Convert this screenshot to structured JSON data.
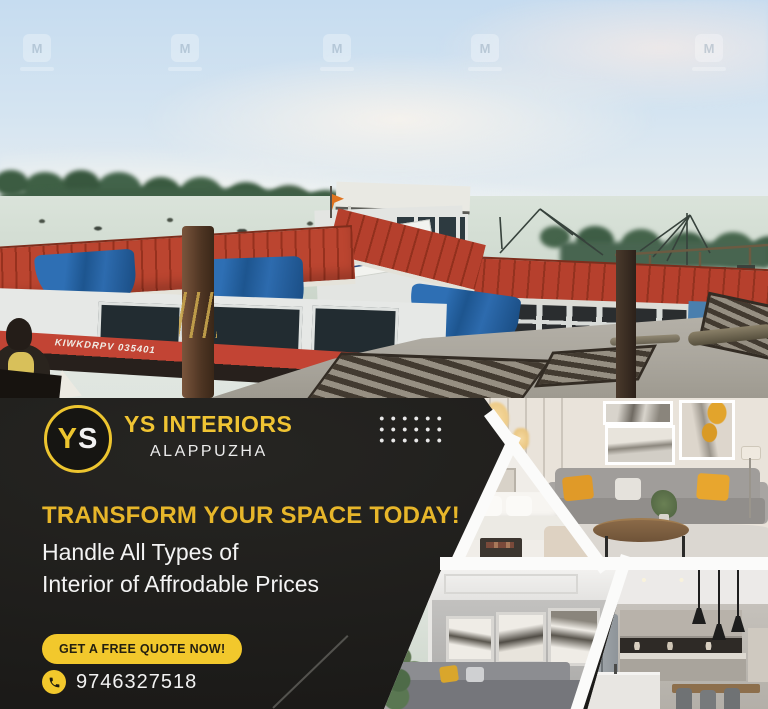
{
  "photo": {
    "watermark_glyph": "M",
    "boat_hull_text": "KIWKDRPV 035401"
  },
  "ad": {
    "logo": {
      "y": "Y",
      "s": "S"
    },
    "brand_name": "YS INTERIORS",
    "brand_location": "ALAPPUZHA",
    "headline": "TRANSFORM YOUR SPACE TODAY!",
    "subline1": "Handle All Types of",
    "subline2": "Interior of Affrodable Prices",
    "cta": "GET A FREE QUOTE NOW!",
    "phone": "9746327518",
    "colors": {
      "accent": "#F2C82C",
      "background": "#1F1E1C",
      "headline": "#E7B62A",
      "text": "#F3F3F3"
    }
  }
}
